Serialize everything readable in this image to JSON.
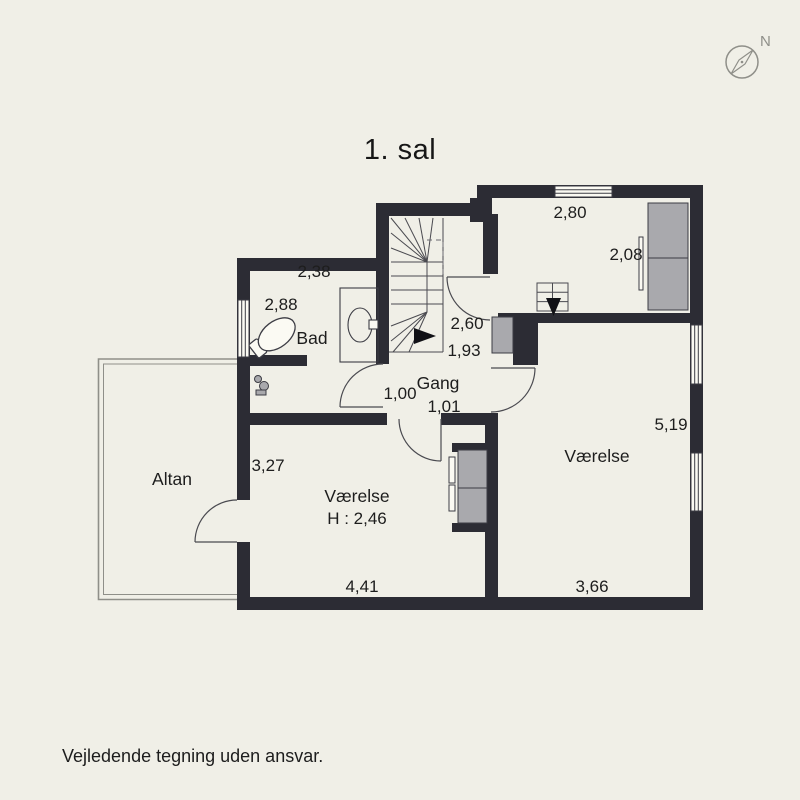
{
  "title": "1. sal",
  "footer_note": "Vejledende tegning uden ansvar.",
  "compass": {
    "north_label": "N"
  },
  "plan": {
    "rooms": {
      "bad": {
        "name": "Bad",
        "width": "2,38",
        "depth": "2,88"
      },
      "gang": {
        "name": "Gang",
        "dim_a": "1,00",
        "dim_b": "1,01"
      },
      "landing": {
        "dim_a": "2,60",
        "dim_b": "1,93"
      },
      "altan": {
        "name": "Altan"
      },
      "room_left": {
        "name": "Værelse",
        "ceiling_height": "H : 2,46",
        "width": "4,41",
        "depth": "3,27"
      },
      "room_right": {
        "name": "Værelse",
        "width": "3,66",
        "depth": "5,19"
      },
      "room_top_right": {
        "width": "2,80",
        "depth": "2,08"
      }
    }
  },
  "colors": {
    "background": "#f0efe7",
    "wall": "#2c2c34",
    "thin_line": "#3c3c44",
    "furniture_grey": "#a9a9ad",
    "compass_grey": "#8f8f89",
    "text": "#1d1d1d",
    "window_white": "#fbfaf3"
  }
}
